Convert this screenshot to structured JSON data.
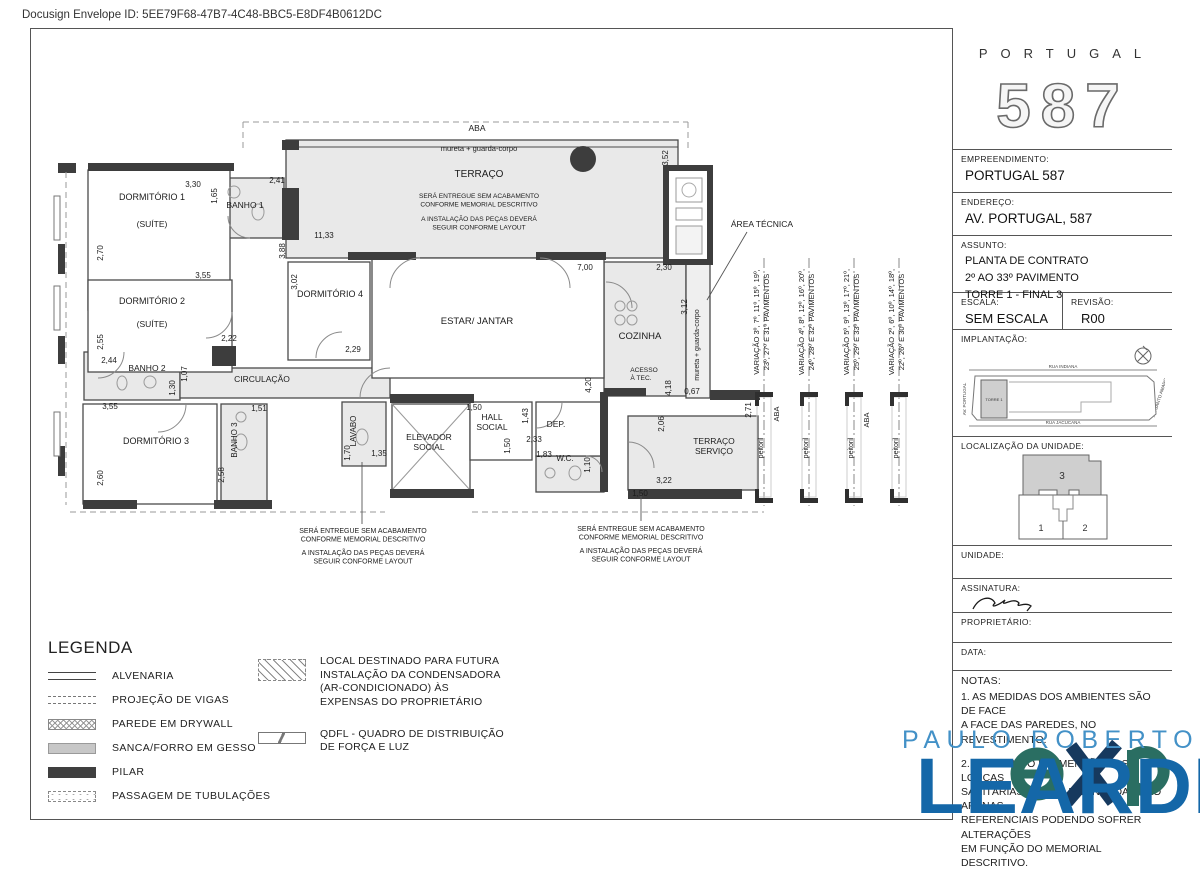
{
  "header": {
    "docusign": "Docusign Envelope ID: 5EE79F68-47B7-4C48-BBC5-E8DF4B0612DC"
  },
  "sidebar": {
    "logo": {
      "brand": "PORTUGAL",
      "number": "587"
    },
    "empreendimento_label": "EMPREENDIMENTO:",
    "empreendimento": "PORTUGAL 587",
    "endereco_label": "ENDEREÇO:",
    "endereco": "AV. PORTUGAL, 587",
    "assunto_label": "ASSUNTO:",
    "assunto_l1": "PLANTA DE CONTRATO",
    "assunto_l2": "2º AO 33º PAVIMENTO",
    "assunto_l3": "TORRE 1 - FINAL 3",
    "escala_label": "ESCALA:",
    "escala": "SEM ESCALA",
    "revisao_label": "REVISÃO:",
    "revisao": "R00",
    "implantacao_label": "IMPLANTAÇÃO:",
    "implantacao": {
      "street_top": "RUA INDIANA",
      "street_bottom": "RUA JACUCANA",
      "street_left": "AV. PORTUGAL",
      "street_right": "AV. SANTO AMARO",
      "tower": "TORRE 1"
    },
    "localizacao_label": "LOCALIZAÇÃO DA UNIDADE:",
    "localizacao": {
      "unit3": "3",
      "unit1": "1",
      "unit2": "2"
    },
    "unidade_label": "UNIDADE:",
    "assinatura_label": "ASSINATURA:",
    "proprietario_label": "PROPRIETÁRIO:",
    "data_label": "DATA:",
    "notas_title": "NOTAS:",
    "notas_1": "1. AS MEDIDAS DOS AMBIENTES SÃO DE FACE\nA FACE DAS PAREDES, NO REVESTIMENTO.",
    "notas_2": "2. O FORMATO E DIMENSÃO DAS LOUÇAS\nSANITÁRIAS, CUBAS E BANCADAS SÃO APENAS\nREFERENCIAIS PODENDO SOFRER ALTERAÇÕES\nEM FUNÇÃO DO MEMORIAL DESCRITIVO."
  },
  "plan": {
    "rooms": {
      "terraco": "TERRAÇO",
      "dorm1": "DORMITÓRIO 1",
      "suite": "(SUÍTE)",
      "banho1": "BANHO 1",
      "dorm2": "DORMITÓRIO 2",
      "banho2": "BANHO 2",
      "circulacao": "CIRCULAÇÃO",
      "dorm3": "DORMITÓRIO 3",
      "banho3": "BANHO 3",
      "dorm4": "DORMITÓRIO 4",
      "estar": "ESTAR/ JANTAR",
      "cozinha": "COZINHA",
      "acesso_l1": "ACESSO",
      "acesso_l2": "À TEC.",
      "lavabo": "LAVABO",
      "elevador_l1": "ELEVADOR",
      "elevador_l2": "SOCIAL",
      "hall_l1": "HALL",
      "hall_l2": "SOCIAL",
      "dep": "DEP.",
      "wc": "W.C.",
      "terr_serv_l1": "TERRAÇO",
      "terr_serv_l2": "SERVIÇO",
      "area_tecnica": "ÁREA TÉCNICA"
    },
    "labels": {
      "aba": "ABA",
      "mureta": "mureta + guarda-corpo",
      "peitoril": "peitoril"
    },
    "notes": {
      "l1": "SERÁ ENTREGUE SEM ACABAMENTO",
      "l2": "CONFORME MEMORIAL DESCRITIVO",
      "l3": "A INSTALAÇÃO DAS PEÇAS DEVERÁ",
      "l4": "SEGUIR CONFORME LAYOUT"
    },
    "variacoes": [
      {
        "l1": "VARIAÇÃO 3º, 7º, 11º, 15º, 19º,",
        "l2": "23º, 27º E 31º PAVIMENTOS"
      },
      {
        "l1": "VARIAÇÃO 4º, 8º, 12º, 16º, 20º,",
        "l2": "24º, 28º E 32º PAVIMENTOS"
      },
      {
        "l1": "VARIAÇÃO 5º, 9º, 13º, 17º, 21º,",
        "l2": "25º, 29º E 33º PAVIMENTOS"
      },
      {
        "l1": "VARIAÇÃO 2º, 6º, 10º, 14º, 18º,",
        "l2": "22º, 26º E 30º PAVIMENTOS"
      }
    ],
    "dims": [
      "3,30",
      "2,41",
      "1,65",
      "2,70",
      "3,55",
      "2,55",
      "2,22",
      "2,44",
      "1,30",
      "1,07",
      "3,55",
      "2,60",
      "1,51",
      "2,58",
      "3,88",
      "3,02",
      "11,33",
      "2,29",
      "7,00",
      "2,30",
      "3,52",
      "1,70",
      "1,35",
      "1,50",
      "1,50",
      "1,43",
      "2,33",
      "1,83",
      "1,10",
      "4,20",
      "3,12",
      "4,18",
      "0,67",
      "2,71",
      "2,06",
      "3,22",
      "1,50"
    ]
  },
  "legend": {
    "title": "LEGENDA",
    "items": [
      "ALVENARIA",
      "PROJEÇÃO DE VIGAS",
      "PAREDE EM DRYWALL",
      "SANCA/FORRO EM GESSO",
      "PILAR",
      "PASSAGEM DE TUBULAÇÕES"
    ],
    "ac_note": "LOCAL DESTINADO PARA FUTURA\nINSTALAÇÃO DA CONDENSADORA\n(AR-CONDICIONADO) ÀS\nEXPENSAS DO PROPRIETÁRIO",
    "qdfl_note": "QDFL - QUADRO DE DISTRIBUIÇÃO\nDE FORÇA E LUZ"
  },
  "watermark": {
    "name": "PAULO ROBERTO",
    "brand": "LEARDI",
    "colors": {
      "light_blue": "#4391c7",
      "blue": "#1467a8",
      "teal": "#2a6e62",
      "navy": "#16395e"
    }
  }
}
